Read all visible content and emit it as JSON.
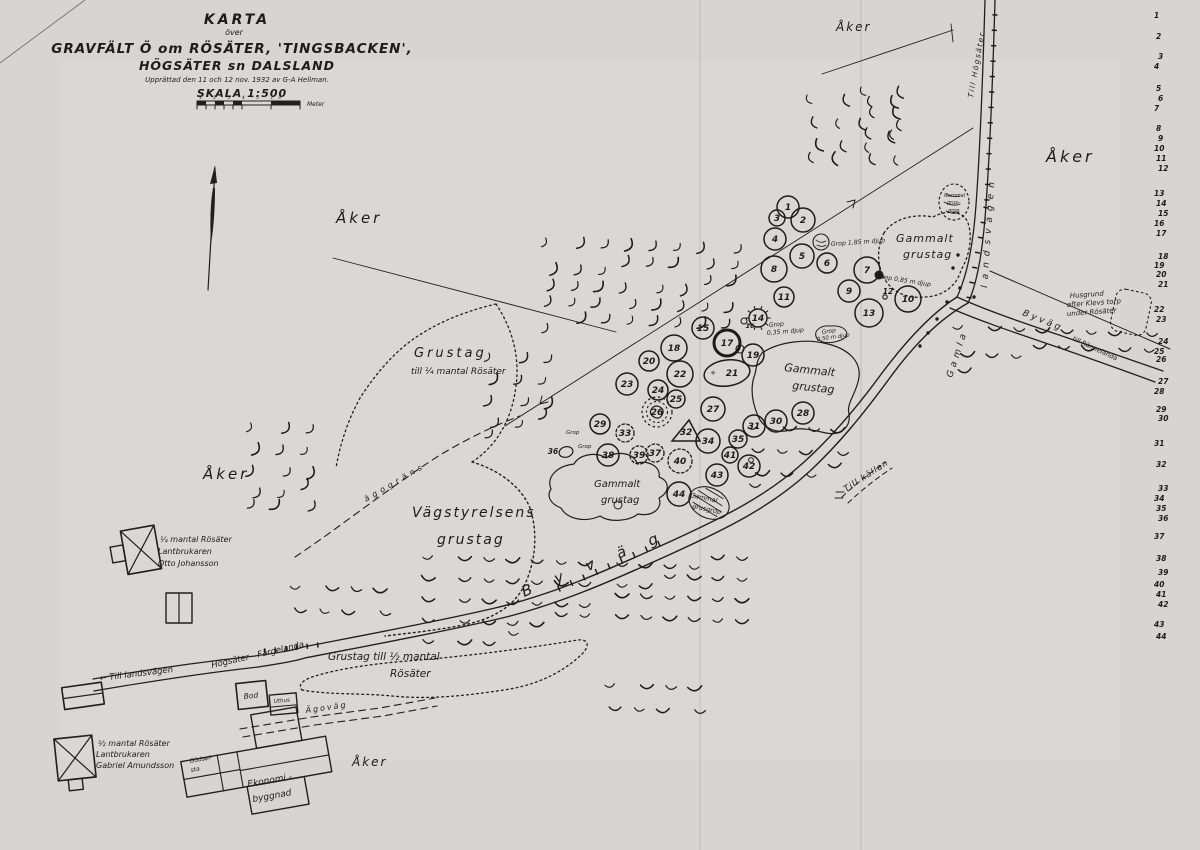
{
  "colors": {
    "ink": "#1d1c1a",
    "paper": "#d7d5d1",
    "paper_light": "#dcdad7"
  },
  "map": {
    "labels": [
      {
        "t": "KARTA",
        "x": 237,
        "y": 24,
        "s": 14,
        "ls": 3,
        "b": 1,
        "a": "m"
      },
      {
        "t": "över",
        "x": 234,
        "y": 35,
        "s": 8,
        "a": "m"
      },
      {
        "t": "GRAVFÄLT Ö om RÖSÄTER, 'TINGSBACKEN',",
        "x": 232,
        "y": 53,
        "s": 13.5,
        "ls": 1,
        "b": 1,
        "a": "m"
      },
      {
        "t": "HÖGSÄTER sn DALSLAND",
        "x": 237,
        "y": 70,
        "s": 12.5,
        "ls": 1,
        "b": 1,
        "a": "m"
      },
      {
        "t": "Upprättad den 11 och 12 nov. 1932 av G-A Hellman.",
        "x": 237,
        "y": 82,
        "s": 7,
        "a": "m"
      },
      {
        "t": "SKALA 1:500",
        "x": 242,
        "y": 97,
        "s": 11,
        "ls": 1,
        "b": 1,
        "a": "m"
      },
      {
        "t": "1 2 3 4 5 10",
        "x": 199,
        "y": 99,
        "s": 4.5,
        "ls": 5
      },
      {
        "t": "Meter",
        "x": 307,
        "y": 106,
        "s": 6
      },
      {
        "t": "Åker",
        "x": 336,
        "y": 223,
        "s": 15,
        "ls": 3
      },
      {
        "t": "Åker",
        "x": 203,
        "y": 479,
        "s": 15,
        "ls": 3
      },
      {
        "t": "Åker",
        "x": 836,
        "y": 31,
        "s": 12,
        "ls": 2
      },
      {
        "t": "Åker",
        "x": 1046,
        "y": 162,
        "s": 16,
        "ls": 3
      },
      {
        "t": "Åker",
        "x": 352,
        "y": 766,
        "s": 12,
        "ls": 2
      },
      {
        "t": "Grustag",
        "x": 414,
        "y": 357,
        "s": 13,
        "ls": 3
      },
      {
        "t": "till ¼ mantal Rösäter",
        "x": 411,
        "y": 374,
        "s": 9
      },
      {
        "t": "Vägstyrelsens",
        "x": 412,
        "y": 517,
        "s": 14,
        "ls": 2
      },
      {
        "t": "grustag",
        "x": 437,
        "y": 544,
        "s": 14,
        "ls": 2
      },
      {
        "t": "Gammalt",
        "x": 896,
        "y": 242,
        "s": 11,
        "ls": 1
      },
      {
        "t": "grustag",
        "x": 903,
        "y": 258,
        "s": 11,
        "ls": 1
      },
      {
        "t": "Gammalt",
        "x": 784,
        "y": 371,
        "s": 11,
        "r": 6
      },
      {
        "t": "grustag",
        "x": 792,
        "y": 389,
        "s": 11,
        "r": 6
      },
      {
        "t": "Gammalt",
        "x": 594,
        "y": 487,
        "s": 10
      },
      {
        "t": "grustag",
        "x": 601,
        "y": 503,
        "s": 10
      },
      {
        "t": "Gammal",
        "x": 944,
        "y": 197,
        "s": 5
      },
      {
        "t": "grus-",
        "x": 947,
        "y": 204,
        "s": 5
      },
      {
        "t": "grop",
        "x": 948,
        "y": 212,
        "s": 5
      },
      {
        "t": "Gammal",
        "x": 690,
        "y": 497,
        "s": 6.5,
        "r": 12
      },
      {
        "t": "grusgrop",
        "x": 692,
        "y": 508,
        "s": 6.5,
        "r": 12
      },
      {
        "t": "Grustag till ½ mantal",
        "x": 328,
        "y": 660,
        "s": 10.5
      },
      {
        "t": "Rösäter",
        "x": 390,
        "y": 677,
        "s": 10.5
      },
      {
        "t": "Till Högsäter",
        "x": 973,
        "y": 98,
        "s": 7.5,
        "ls": 1.5,
        "r": -80
      },
      {
        "t": "landsvägen",
        "x": 987,
        "y": 288,
        "s": 9,
        "ls": 6,
        "r": -86
      },
      {
        "t": "Gamla",
        "x": 952,
        "y": 378,
        "s": 9,
        "ls": 4,
        "r": -72
      },
      {
        "t": "Byväg",
        "x": 1022,
        "y": 315,
        "s": 9,
        "ls": 3,
        "r": 22
      },
      {
        "t": "till Rännelanda",
        "x": 1072,
        "y": 340,
        "s": 6.5,
        "r": 25
      },
      {
        "t": "B y v ä g",
        "x": 524,
        "y": 597,
        "s": 15,
        "ls": 10,
        "r": -22
      },
      {
        "t": "← Till landsvägen",
        "x": 100,
        "y": 681,
        "s": 8.5,
        "r": -7
      },
      {
        "t": "Högsäter - Färgelanda",
        "x": 212,
        "y": 668,
        "s": 8.5,
        "r": -13
      },
      {
        "t": "Ägoväg",
        "x": 306,
        "y": 713,
        "s": 8,
        "ls": 2,
        "r": -8
      },
      {
        "t": "ägogräns",
        "x": 366,
        "y": 502,
        "s": 8,
        "ls": 4,
        "r": -30
      },
      {
        "t": "Till källan",
        "x": 846,
        "y": 492,
        "s": 8.5,
        "ls": 1,
        "r": -33
      },
      {
        "t": "Grop 1,85 m djup",
        "x": 831,
        "y": 246,
        "s": 6.2,
        "r": -4
      },
      {
        "t": "Grop 0,85 m djup",
        "x": 877,
        "y": 278,
        "s": 6.2,
        "r": 9
      },
      {
        "t": "Grop",
        "x": 769,
        "y": 327,
        "s": 6.2,
        "r": -5
      },
      {
        "t": "0,35 m djup",
        "x": 767,
        "y": 335,
        "s": 6.2,
        "r": -5
      },
      {
        "t": "Grop",
        "x": 822,
        "y": 334,
        "s": 5.8,
        "r": -8
      },
      {
        "t": "0,50 m djup",
        "x": 817,
        "y": 341,
        "s": 5.5,
        "r": -8
      },
      {
        "t": "Husgrund",
        "x": 1070,
        "y": 298,
        "s": 7,
        "r": -4
      },
      {
        "t": "efter Klevs torp",
        "x": 1067,
        "y": 307,
        "s": 7,
        "r": -4
      },
      {
        "t": "under Rösäter",
        "x": 1067,
        "y": 316,
        "s": 7,
        "r": -4
      },
      {
        "t": "Grop",
        "x": 566,
        "y": 434,
        "s": 5.5
      },
      {
        "t": "Grop",
        "x": 578,
        "y": 448,
        "s": 5.5
      },
      {
        "t": "¼ mantal Rösäter",
        "x": 160,
        "y": 542,
        "s": 8
      },
      {
        "t": "Lantbrukaren",
        "x": 158,
        "y": 554,
        "s": 8
      },
      {
        "t": "Otto Johansson",
        "x": 158,
        "y": 566,
        "s": 8
      },
      {
        "t": "½ mantal Rösäter",
        "x": 98,
        "y": 746,
        "s": 8
      },
      {
        "t": "Lantbrukaren",
        "x": 96,
        "y": 757,
        "s": 8
      },
      {
        "t": "Gabriel Amundsson",
        "x": 96,
        "y": 768,
        "s": 8
      },
      {
        "t": "Bod",
        "x": 244,
        "y": 699,
        "s": 7.5,
        "r": -6
      },
      {
        "t": "Uthus",
        "x": 274,
        "y": 703,
        "s": 5.5,
        "r": -5
      },
      {
        "t": "Gödsel-",
        "x": 190,
        "y": 763,
        "s": 6,
        "r": -10
      },
      {
        "t": "sta",
        "x": 191,
        "y": 772,
        "s": 6,
        "r": -10
      },
      {
        "t": "Ekonomi -",
        "x": 248,
        "y": 787,
        "s": 9,
        "r": -10
      },
      {
        "t": "byggnad",
        "x": 253,
        "y": 802,
        "s": 9,
        "r": -10
      }
    ],
    "graves": [
      {
        "n": "1",
        "x": 788,
        "y": 207,
        "r": 11
      },
      {
        "n": "2",
        "x": 803,
        "y": 220,
        "r": 12
      },
      {
        "n": "3",
        "x": 777,
        "y": 218,
        "r": 8
      },
      {
        "n": "4",
        "x": 775,
        "y": 239,
        "r": 11
      },
      {
        "n": "5",
        "x": 802,
        "y": 256,
        "r": 12
      },
      {
        "n": "6",
        "x": 827,
        "y": 263,
        "r": 10
      },
      {
        "n": "7",
        "x": 867,
        "y": 270,
        "r": 13,
        "ext": [
          12,
          5,
          4.5
        ]
      },
      {
        "n": "8",
        "x": 774,
        "y": 269,
        "r": 13
      },
      {
        "n": "9",
        "x": 849,
        "y": 291,
        "r": 11
      },
      {
        "n": "10",
        "x": 908,
        "y": 299,
        "r": 13
      },
      {
        "n": "11",
        "x": 784,
        "y": 297,
        "r": 10
      },
      {
        "n": "12",
        "x": 888,
        "y": 291,
        "r": 0,
        "st": "txt",
        "ext": [
          -3,
          6,
          2.2
        ]
      },
      {
        "n": "13",
        "x": 869,
        "y": 313,
        "r": 14
      },
      {
        "n": "14",
        "x": 758,
        "y": 318,
        "r": 9,
        "st": "rose"
      },
      {
        "n": "15",
        "x": 703,
        "y": 328,
        "r": 11
      },
      {
        "n": "16",
        "x": 750,
        "y": 325,
        "r": 0,
        "st": "txt",
        "ext": [
          -6,
          -4,
          3
        ]
      },
      {
        "n": "17",
        "x": 727,
        "y": 343,
        "r": 13,
        "st": "bold",
        "ext": [
          13,
          6,
          4
        ]
      },
      {
        "n": "18",
        "x": 674,
        "y": 348,
        "r": 13
      },
      {
        "n": "19",
        "x": 753,
        "y": 355,
        "r": 11
      },
      {
        "n": "20",
        "x": 649,
        "y": 361,
        "r": 10
      },
      {
        "n": "21",
        "x": 727,
        "y": 373,
        "r": 0,
        "st": "oval"
      },
      {
        "n": "22",
        "x": 680,
        "y": 374,
        "r": 13
      },
      {
        "n": "23",
        "x": 627,
        "y": 384,
        "r": 11
      },
      {
        "n": "24",
        "x": 658,
        "y": 390,
        "r": 10
      },
      {
        "n": "25",
        "x": 676,
        "y": 399,
        "r": 9
      },
      {
        "n": "26",
        "x": 657,
        "y": 412,
        "r": 15,
        "st": "ddash"
      },
      {
        "n": "27",
        "x": 713,
        "y": 409,
        "r": 12
      },
      {
        "n": "28",
        "x": 803,
        "y": 413,
        "r": 11
      },
      {
        "n": "29",
        "x": 600,
        "y": 424,
        "r": 10
      },
      {
        "n": "30",
        "x": 776,
        "y": 421,
        "r": 11
      },
      {
        "n": "31",
        "x": 754,
        "y": 426,
        "r": 11
      },
      {
        "n": "32",
        "x": 686,
        "y": 432,
        "r": 0,
        "st": "tri"
      },
      {
        "n": "33",
        "x": 625,
        "y": 433,
        "r": 9,
        "st": "dash"
      },
      {
        "n": "34",
        "x": 708,
        "y": 441,
        "r": 12
      },
      {
        "n": "35",
        "x": 738,
        "y": 439,
        "r": 9
      },
      {
        "n": "36",
        "x": 553,
        "y": 451,
        "r": 0,
        "st": "txt",
        "ext": [
          13,
          1,
          7
        ]
      },
      {
        "n": "37",
        "x": 655,
        "y": 453,
        "r": 9,
        "st": "dash"
      },
      {
        "n": "38",
        "x": 608,
        "y": 455,
        "r": 11
      },
      {
        "n": "39",
        "x": 639,
        "y": 455,
        "r": 9,
        "st": "dash"
      },
      {
        "n": "40",
        "x": 680,
        "y": 461,
        "r": 12,
        "st": "dash"
      },
      {
        "n": "41",
        "x": 730,
        "y": 455,
        "r": 8
      },
      {
        "n": "42",
        "x": 749,
        "y": 466,
        "r": 11,
        "st": "inner"
      },
      {
        "n": "43",
        "x": 717,
        "y": 475,
        "r": 11
      },
      {
        "n": "44",
        "x": 679,
        "y": 494,
        "r": 12
      }
    ],
    "legend": [
      {
        "n": "1",
        "y": 14
      },
      {
        "n": "2",
        "y": 35
      },
      {
        "n": "3",
        "y": 55
      },
      {
        "n": "4",
        "y": 65
      },
      {
        "n": "5",
        "y": 87
      },
      {
        "n": "6",
        "y": 97
      },
      {
        "n": "7",
        "y": 107
      },
      {
        "n": "8",
        "y": 127
      },
      {
        "n": "9",
        "y": 137
      },
      {
        "n": "10",
        "y": 147
      },
      {
        "n": "11",
        "y": 157
      },
      {
        "n": "12",
        "y": 167
      },
      {
        "n": "13",
        "y": 192
      },
      {
        "n": "14",
        "y": 202
      },
      {
        "n": "15",
        "y": 212
      },
      {
        "n": "16",
        "y": 222
      },
      {
        "n": "17",
        "y": 232
      },
      {
        "n": "18",
        "y": 255
      },
      {
        "n": "19",
        "y": 264
      },
      {
        "n": "20",
        "y": 273
      },
      {
        "n": "21",
        "y": 283
      },
      {
        "n": "22",
        "y": 308
      },
      {
        "n": "23",
        "y": 318
      },
      {
        "n": "24",
        "y": 340
      },
      {
        "n": "25",
        "y": 350
      },
      {
        "n": "26",
        "y": 358
      },
      {
        "n": "27",
        "y": 380
      },
      {
        "n": "28",
        "y": 390
      },
      {
        "n": "29",
        "y": 408
      },
      {
        "n": "30",
        "y": 417
      },
      {
        "n": "31",
        "y": 442
      },
      {
        "n": "32",
        "y": 463
      },
      {
        "n": "33",
        "y": 487
      },
      {
        "n": "34",
        "y": 497
      },
      {
        "n": "35",
        "y": 507
      },
      {
        "n": "36",
        "y": 517
      },
      {
        "n": "37",
        "y": 535
      },
      {
        "n": "38",
        "y": 557
      },
      {
        "n": "39",
        "y": 571
      },
      {
        "n": "40",
        "y": 583
      },
      {
        "n": "41",
        "y": 593
      },
      {
        "n": "42",
        "y": 603
      },
      {
        "n": "43",
        "y": 623
      },
      {
        "n": "44",
        "y": 635
      }
    ]
  }
}
